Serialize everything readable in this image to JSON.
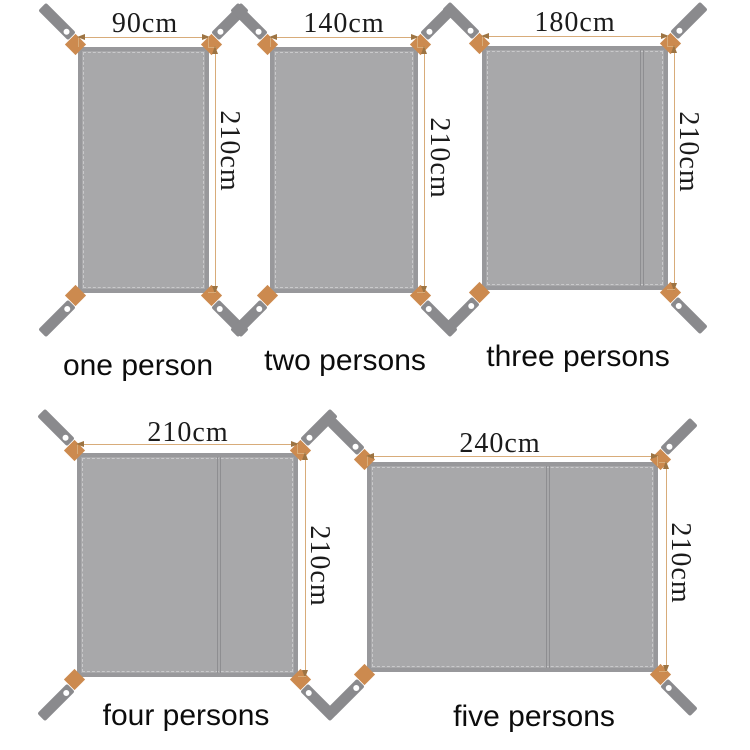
{
  "colors": {
    "bg": "#ffffff",
    "tarp": "#a8a8aa",
    "tarpEdge": "#98989b",
    "stitch": "#c9c9cb",
    "seam": "#8e8e91",
    "strap": "#8a8a8d",
    "grommet": "#ffffff",
    "patch": "#cc8a4f",
    "dimLine": "#d8ac7a",
    "dimArrow": "#9d7443",
    "dimText": "#1b1b1b",
    "labelText": "#0c0c0c"
  },
  "tarps": [
    {
      "label": "one person",
      "width_label": "90cm",
      "height_label": "210cm",
      "width_cm": 90,
      "height_cm": 210,
      "seam": false
    },
    {
      "label": "two persons",
      "width_label": "140cm",
      "height_label": "210cm",
      "width_cm": 140,
      "height_cm": 210,
      "seam": false
    },
    {
      "label": "three persons",
      "width_label": "180cm",
      "height_label": "210cm",
      "width_cm": 180,
      "height_cm": 210,
      "seam": true
    },
    {
      "label": "four persons",
      "width_label": "210cm",
      "height_label": "210cm",
      "width_cm": 210,
      "height_cm": 210,
      "seam": true
    },
    {
      "label": "five persons",
      "width_label": "240cm",
      "height_label": "210cm",
      "width_cm": 240,
      "height_cm": 210,
      "seam": true
    }
  ]
}
